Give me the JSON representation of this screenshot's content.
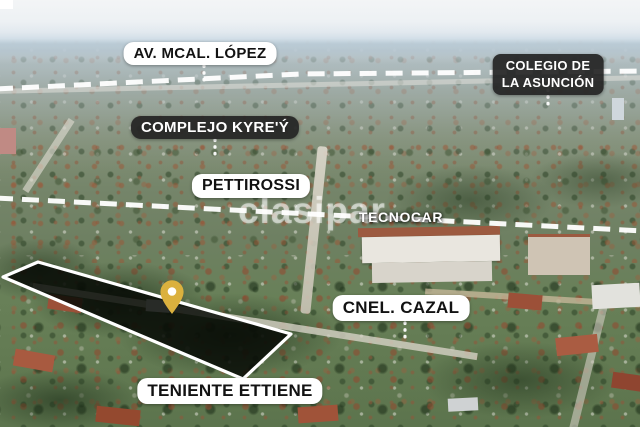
{
  "watermark": "clasipar",
  "labels": {
    "av_mcal_lopez": "AV. MCAL. LÓPEZ",
    "colegio_line1": "COLEGIO DE",
    "colegio_line2": "LA ASUNCIÓN",
    "complejo_kyrey": "COMPLEJO KYRE'Ý",
    "pettirossi": "PETTIROSSI",
    "tecnocar": "TECNOCAR",
    "cnel_cazal": "CNEL. CAZAL",
    "teniente_ettiene": "TENIENTE ETTIENE"
  },
  "marker": {
    "color": "#DBB13E"
  },
  "colors": {
    "label_light_bg": "#FFFFFF",
    "label_light_text": "#121212",
    "label_dark_bg": "#232323",
    "label_dark_text": "#FFFFFF",
    "route_dash": "#FFFFFF",
    "property_outline": "#FFFFFF"
  }
}
